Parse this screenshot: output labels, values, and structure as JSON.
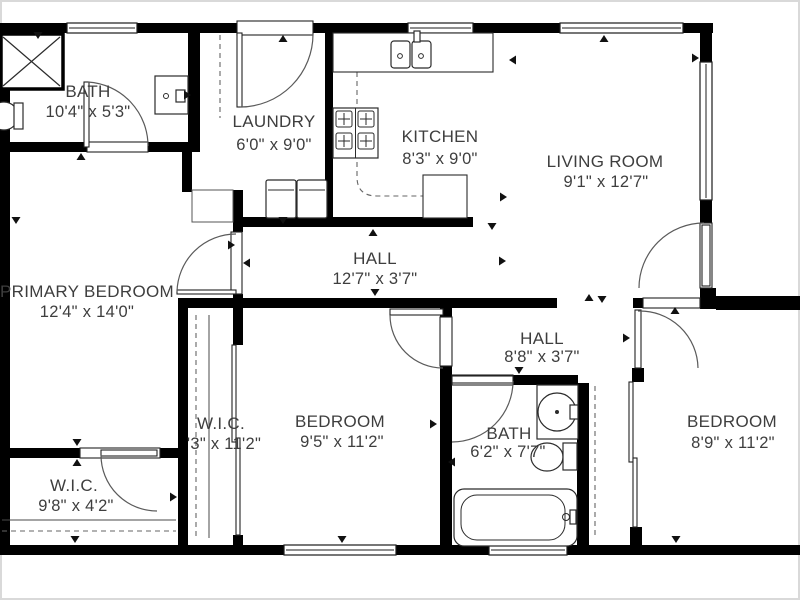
{
  "colors": {
    "background": "#ffffff",
    "wall": "#000000",
    "text": "#3e3e3e",
    "line": "#5a5a5a",
    "border": "#d9d9d9"
  },
  "rooms": [
    {
      "id": "bath-top",
      "name": "BATH",
      "dims": "10'4\" x 5'3\""
    },
    {
      "id": "laundry",
      "name": "LAUNDRY",
      "dims": "6'0\" x 9'0\""
    },
    {
      "id": "kitchen",
      "name": "KITCHEN",
      "dims": "8'3\" x 9'0\""
    },
    {
      "id": "living-room",
      "name": "LIVING ROOM",
      "dims": "9'1\" x 12'7\""
    },
    {
      "id": "primary-bedroom",
      "name": "PRIMARY BEDROOM",
      "dims": "12'4\" x 14'0\""
    },
    {
      "id": "hall-main",
      "name": "HALL",
      "dims": "12'7\" x 3'7\""
    },
    {
      "id": "hall-rear",
      "name": "HALL",
      "dims": "8'8\" x 3'7\""
    },
    {
      "id": "wic-center",
      "name": "W.I.C.",
      "dims": "'3\" x 11'2\""
    },
    {
      "id": "bedroom-center",
      "name": "BEDROOM",
      "dims": "9'5\" x 11'2\""
    },
    {
      "id": "bath-center",
      "name": "BATH",
      "dims": "6'2\" x 7'7\""
    },
    {
      "id": "bedroom-right",
      "name": "BEDROOM",
      "dims": "8'9\" x 11'2\""
    },
    {
      "id": "wic-left",
      "name": "W.I.C.",
      "dims": "9'8\" x 4'2\""
    }
  ],
  "fixtures": [
    "shower",
    "toilet",
    "vanity-sink",
    "kitchen-sink",
    "stove",
    "counter",
    "washer",
    "dryer",
    "bathtub",
    "closet-rod",
    "sliding-door"
  ]
}
